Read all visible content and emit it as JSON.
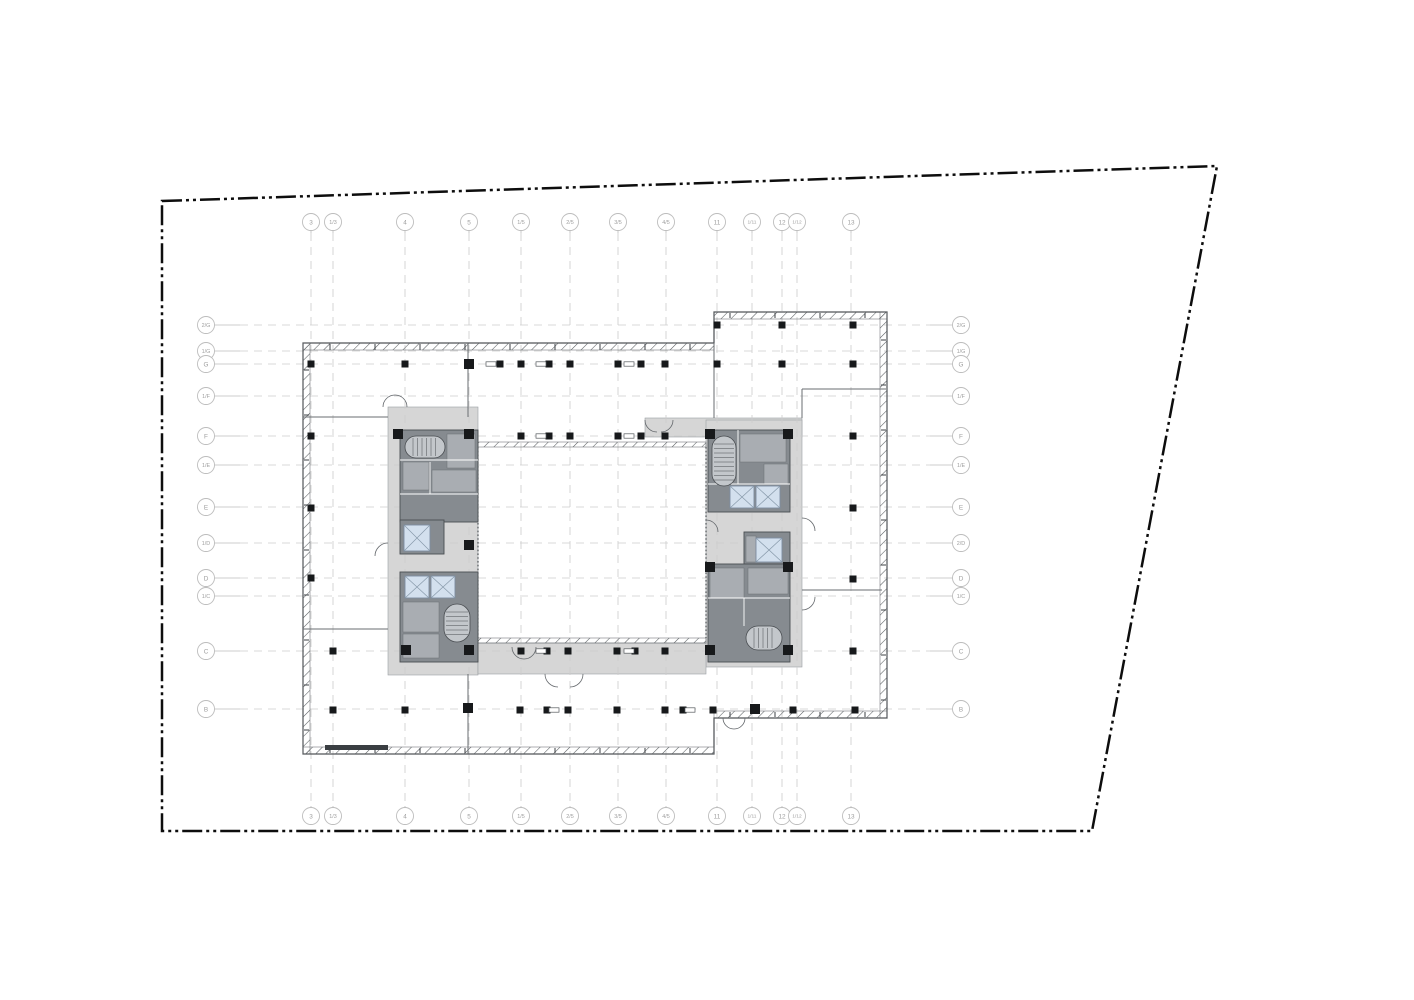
{
  "drawing": {
    "grid": {
      "columns": [
        {
          "label": "3",
          "x": 311
        },
        {
          "label": "1/3",
          "x": 333
        },
        {
          "label": "4",
          "x": 405
        },
        {
          "label": "5",
          "x": 469
        },
        {
          "label": "1/5",
          "x": 521
        },
        {
          "label": "2/5",
          "x": 570
        },
        {
          "label": "3/5",
          "x": 618
        },
        {
          "label": "4/5",
          "x": 666
        },
        {
          "label": "11",
          "x": 717
        },
        {
          "label": "1/11",
          "x": 752
        },
        {
          "label": "12",
          "x": 782
        },
        {
          "label": "1/12",
          "x": 797
        },
        {
          "label": "13",
          "x": 851
        }
      ],
      "rows": [
        {
          "left": "2/G",
          "right": "2/G",
          "y": 325
        },
        {
          "left": "1/G",
          "right": "1/G",
          "y": 351
        },
        {
          "left": "G",
          "right": "G",
          "y": 364
        },
        {
          "left": "1/F",
          "right": "1/F",
          "y": 396
        },
        {
          "left": "F",
          "right": "F",
          "y": 436
        },
        {
          "left": "1/E",
          "right": "1/E",
          "y": 465
        },
        {
          "left": "E",
          "right": "E",
          "y": 507
        },
        {
          "left": "1/D",
          "right": "2/D",
          "y": 543
        },
        {
          "left": "D",
          "right": "D",
          "y": 578
        },
        {
          "left": "1/C",
          "right": "1/C",
          "y": 596
        },
        {
          "left": "C",
          "right": "C",
          "y": 651
        },
        {
          "left": "B",
          "right": "B",
          "y": 709
        }
      ],
      "top_bubble_y": 222,
      "bottom_bubble_y": 816,
      "left_bubble_x": 206,
      "right_bubble_x": 961,
      "line_top_y": 233,
      "line_bottom_y": 806,
      "line_left_x": 240,
      "line_right_x": 930
    },
    "colors": {
      "property_line": "#0d0d0d",
      "grid_line": "#cccccc",
      "bubble_stroke": "#bdbdbd",
      "bubble_text": "#9e9e9e",
      "wall": "#4a4e52",
      "corridor_fill": "#d6d6d6",
      "room_fill": "#868b90",
      "room_light": "#a9adb2",
      "elevator_fill": "#d3e0ee",
      "column_fill": "#17191b"
    }
  }
}
